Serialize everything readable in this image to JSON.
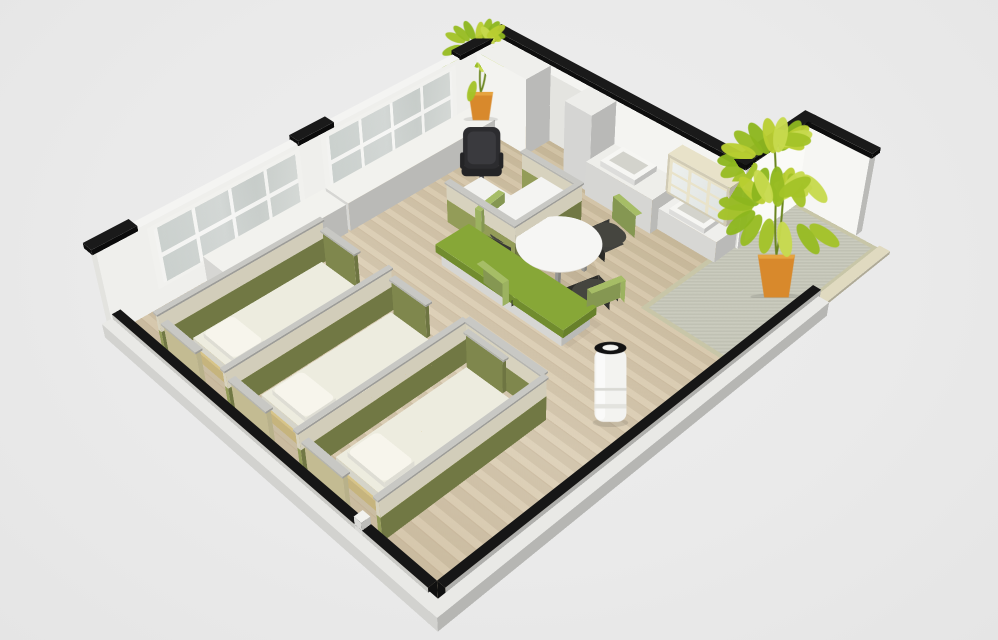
{
  "meta": {
    "title": "3D cutaway floor plan render",
    "description": "Isometric 3D cutaway render of an office rest suite: glazed window wall with low sideboards, kitchenette wall with two sinks and glass display cabinet, staff desk with black office chair behind green and cream privacy partitions, green upholstered bench, round white table with four chairs, three partitioned nap beds with white mattresses and pillows, cylindrical air purifier, two potted plants in orange pots, gray entry rug and entry alcove",
    "background": "#ebebeb"
  },
  "palette": {
    "bg": "#ebebeb",
    "wall_white": "#f2f2ef",
    "wall_cap_black": "#161616",
    "floor_wood": "#d8c9ae",
    "floor_rim": "#e9e9e6",
    "carpet_gray": "#c7c8ba",
    "carpet_edge": "#c8c6a8",
    "partition_green": "#8d9655",
    "partition_cream": "#efe9d3",
    "partition_khaki": "#d9d0a2",
    "partition_frame": "#c8c8c4",
    "bed_frame_tan": "#d7c488",
    "mattress_white": "#edecdf",
    "pillow_white": "#f7f5ec",
    "bench_green": "#7e9c33",
    "chair_seat_dark": "#3c3c38",
    "chair_back_green": "#a6bd66",
    "office_chair_black": "#2c2c2f",
    "table_white": "#f6f6f4",
    "cabinet_white": "#eeeeea",
    "door_white": "#fbfbf9",
    "window_glass": "#ccd2cf",
    "plant_green": "#aec62c",
    "pot_orange": "#d8892c",
    "purifier_white": "#f3f3f0",
    "metal_gray": "#a8a8a4"
  },
  "inventory": {
    "beds": 3,
    "bed_cubicles": 3,
    "table_chairs": 4,
    "plants": 2,
    "sinks": 2,
    "windows": 2,
    "items": [
      {
        "name": "window-wall",
        "label": "Glazed window wall with black wall caps"
      },
      {
        "name": "sideboards",
        "label": "Low white sideboard cabinets along window wall"
      },
      {
        "name": "wardrobe",
        "label": "Tall white wardrobe cabinet at corner"
      },
      {
        "name": "door",
        "label": "White interior door on kitchenette wall"
      },
      {
        "name": "kitchenette",
        "label": "Kitchenette counters with two white sinks"
      },
      {
        "name": "display-cabinet",
        "label": "Glass-front display cabinet with cream frames"
      },
      {
        "name": "desk-station",
        "label": "Staff desk with black office chair and partition screens"
      },
      {
        "name": "bench",
        "label": "Green upholstered bench on white base"
      },
      {
        "name": "meeting-table",
        "label": "Round white table with four green-back chairs"
      },
      {
        "name": "nap-beds",
        "label": "Three screened nap beds with white mattresses and pillows"
      },
      {
        "name": "air-purifier",
        "label": "White cylindrical air purifier"
      },
      {
        "name": "plant-small",
        "label": "Potted plant on sideboard in orange pot"
      },
      {
        "name": "plant-large",
        "label": "Tall potted plant in orange pot at entry alcove"
      },
      {
        "name": "entry-rug",
        "label": "Gray area rug at entry"
      },
      {
        "name": "low-walls",
        "label": "Cutaway low walls with black tops"
      }
    ]
  }
}
